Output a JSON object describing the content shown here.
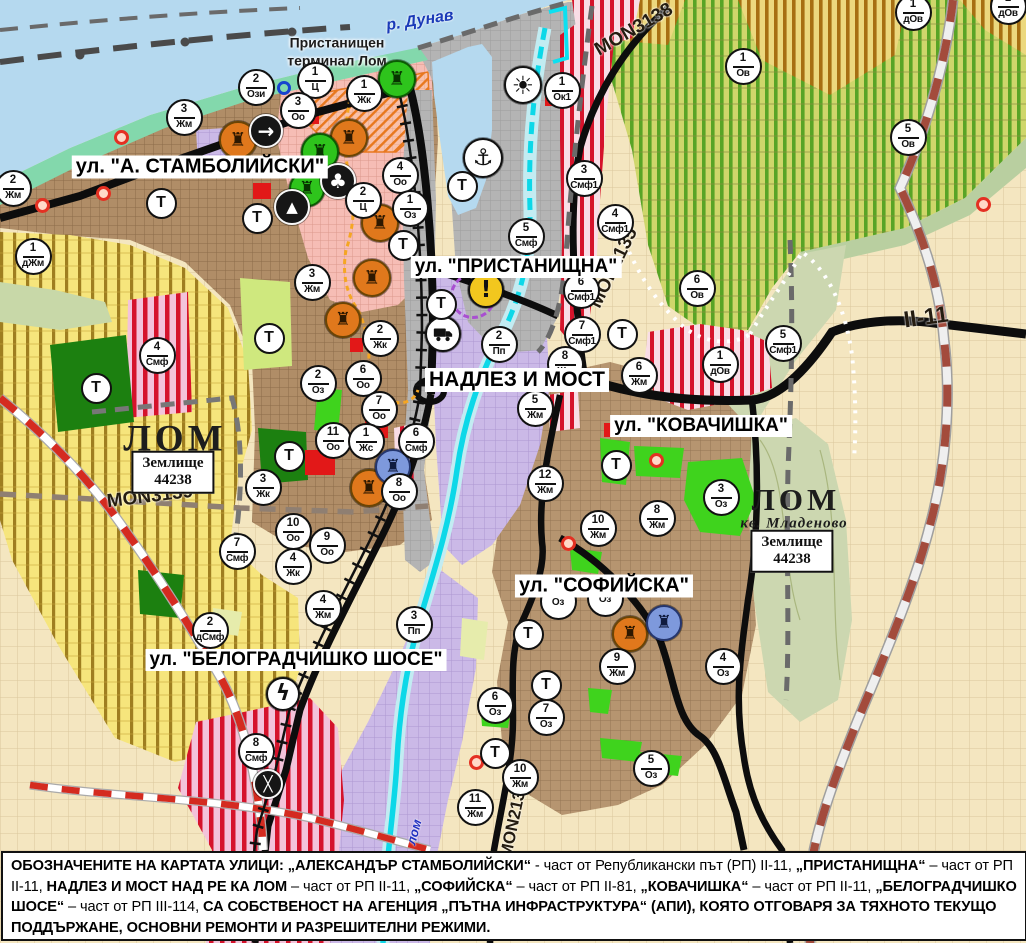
{
  "map": {
    "terminal_label": {
      "line1": "Пристанищен",
      "line2": "терминал Лом",
      "x": 337,
      "y": 52
    },
    "street_labels": [
      {
        "t": "ул. \"А. СТАМБОЛИЙСКИ\"",
        "x": 200,
        "y": 167,
        "fs": 20
      },
      {
        "t": "ул. \"ПРИСТАНИЩНА\"",
        "x": 516,
        "y": 267,
        "fs": 19
      },
      {
        "t": "НАДЛЕЗ И МОСТ",
        "x": 517,
        "y": 380,
        "fs": 21
      },
      {
        "t": "ул. \"КОВАЧИШКА\"",
        "x": 701,
        "y": 426,
        "fs": 19
      },
      {
        "t": "ул. \"СОФИЙСКА\"",
        "x": 604,
        "y": 586,
        "fs": 20
      },
      {
        "t": "ул. \"БЕЛОГРАДЧИШКО ШОСЕ\"",
        "x": 296,
        "y": 660,
        "fs": 19
      }
    ],
    "road_labels": [
      {
        "t": "MON3139",
        "x": 150,
        "y": 497,
        "rot": -7,
        "fs": 19
      },
      {
        "t": "MON3138",
        "x": 634,
        "y": 30,
        "rot": -30,
        "fs": 19
      },
      {
        "t": "MON2135",
        "x": 614,
        "y": 268,
        "rot": -64,
        "fs": 19
      },
      {
        "t": "MON2136",
        "x": 514,
        "y": 820,
        "rot": -78,
        "fs": 17
      },
      {
        "t": "II-11",
        "x": 926,
        "y": 317,
        "rot": -8,
        "fs": 23
      }
    ],
    "river_labels": [
      {
        "t": "р. Дунав",
        "x": 420,
        "y": 21,
        "rot": -9,
        "fs": 16,
        "color": "#1a3ab8"
      },
      {
        "t": "лом",
        "x": 414,
        "y": 832,
        "rot": -75,
        "fs": 13,
        "color": "#2030c0"
      }
    ],
    "city_labels": [
      {
        "t": "ЛОМ",
        "x": 175,
        "y": 439,
        "fs": 37,
        "italic": false
      },
      {
        "t": "ЛОМ",
        "x": 796,
        "y": 500,
        "fs": 31,
        "italic": false
      },
      {
        "t": "кв. Младеново",
        "x": 794,
        "y": 524,
        "fs": 15,
        "italic": true
      }
    ],
    "landholding_boxes": [
      {
        "title": "Землище",
        "number": "44238",
        "x": 173,
        "y": 472
      },
      {
        "title": "Землище",
        "number": "44238",
        "x": 792,
        "y": 551
      }
    ],
    "t_symbol": "Т",
    "t_badges": [
      {
        "x": 161,
        "y": 203
      },
      {
        "x": 257,
        "y": 218
      },
      {
        "x": 269,
        "y": 338
      },
      {
        "x": 289,
        "y": 456
      },
      {
        "x": 96,
        "y": 388
      },
      {
        "x": 441,
        "y": 304
      },
      {
        "x": 462,
        "y": 186
      },
      {
        "x": 403,
        "y": 245
      },
      {
        "x": 622,
        "y": 334
      },
      {
        "x": 616,
        "y": 465
      },
      {
        "x": 528,
        "y": 634
      },
      {
        "x": 546,
        "y": 685
      },
      {
        "x": 495,
        "y": 753
      }
    ],
    "badges": [
      {
        "n": "2",
        "c": "Ози",
        "x": 256,
        "y": 87
      },
      {
        "n": "1",
        "c": "Ц",
        "x": 315,
        "y": 80
      },
      {
        "n": "3",
        "c": "Оо",
        "x": 298,
        "y": 110
      },
      {
        "n": "1",
        "c": "Жк",
        "x": 364,
        "y": 93
      },
      {
        "n": "1",
        "c": "Ок1",
        "x": 562,
        "y": 90
      },
      {
        "n": "3",
        "c": "Жм",
        "x": 184,
        "y": 117
      },
      {
        "n": "2",
        "c": "Жм",
        "x": 13,
        "y": 188
      },
      {
        "n": "1",
        "c": "дЖм",
        "x": 33,
        "y": 256
      },
      {
        "n": "3",
        "c": "Жм",
        "x": 312,
        "y": 282
      },
      {
        "n": "4",
        "c": "Оо",
        "x": 400,
        "y": 175
      },
      {
        "n": "2",
        "c": "Ц",
        "x": 363,
        "y": 200
      },
      {
        "n": "1",
        "c": "Оз",
        "x": 410,
        "y": 208
      },
      {
        "n": "5",
        "c": "Смф",
        "x": 526,
        "y": 236
      },
      {
        "n": "3",
        "c": "Смф1",
        "x": 584,
        "y": 178
      },
      {
        "n": "4",
        "c": "Смф1",
        "x": 615,
        "y": 222
      },
      {
        "n": "6",
        "c": "Смф1",
        "x": 581,
        "y": 290
      },
      {
        "n": "7",
        "c": "Смф1",
        "x": 582,
        "y": 334
      },
      {
        "n": "8",
        "c": "Жм",
        "x": 565,
        "y": 364
      },
      {
        "n": "6",
        "c": "Жм",
        "x": 639,
        "y": 375
      },
      {
        "n": "6",
        "c": "Ов",
        "x": 697,
        "y": 288
      },
      {
        "n": "1",
        "c": "дОв",
        "x": 720,
        "y": 364
      },
      {
        "n": "5",
        "c": "Смф1",
        "x": 783,
        "y": 343
      },
      {
        "n": "1",
        "c": "Ов",
        "x": 743,
        "y": 66
      },
      {
        "n": "5",
        "c": "Ов",
        "x": 908,
        "y": 137
      },
      {
        "n": "1",
        "c": "дОв",
        "x": 913,
        "y": 12
      },
      {
        "n": "1",
        "c": "дОв",
        "x": 1008,
        "y": 6
      },
      {
        "n": "2",
        "c": "Пп",
        "x": 499,
        "y": 344
      },
      {
        "n": "5",
        "c": "Жм",
        "x": 535,
        "y": 408
      },
      {
        "n": "12",
        "c": "Жм",
        "x": 545,
        "y": 483
      },
      {
        "n": "6",
        "c": "Смф",
        "x": 416,
        "y": 441
      },
      {
        "n": "2",
        "c": "Оз",
        "x": 318,
        "y": 383
      },
      {
        "n": "11",
        "c": "Оо",
        "x": 333,
        "y": 440
      },
      {
        "n": "2",
        "c": "Жк",
        "x": 380,
        "y": 338
      },
      {
        "n": "6",
        "c": "Оо",
        "x": 363,
        "y": 378
      },
      {
        "n": "7",
        "c": "Оо",
        "x": 379,
        "y": 409
      },
      {
        "n": "1",
        "c": "Жс",
        "x": 366,
        "y": 441
      },
      {
        "n": "8",
        "c": "Оо",
        "x": 399,
        "y": 491
      },
      {
        "n": "3",
        "c": "Жк",
        "x": 263,
        "y": 487
      },
      {
        "n": "10",
        "c": "Оо",
        "x": 293,
        "y": 531
      },
      {
        "n": "9",
        "c": "Оо",
        "x": 327,
        "y": 545
      },
      {
        "n": "7",
        "c": "Смф",
        "x": 237,
        "y": 551
      },
      {
        "n": "4",
        "c": "Жк",
        "x": 293,
        "y": 566
      },
      {
        "n": "4",
        "c": "Смф",
        "x": 157,
        "y": 355
      },
      {
        "n": "2",
        "c": "дСмф",
        "x": 210,
        "y": 630
      },
      {
        "n": "4",
        "c": "Жм",
        "x": 323,
        "y": 608
      },
      {
        "n": "3",
        "c": "Пп",
        "x": 414,
        "y": 624
      },
      {
        "n": "8",
        "c": "Смф",
        "x": 256,
        "y": 751
      },
      {
        "n": "8",
        "c": "Жм",
        "x": 657,
        "y": 518
      },
      {
        "n": "10",
        "c": "Жм",
        "x": 598,
        "y": 528
      },
      {
        "n": "3",
        "c": "Оз",
        "x": 721,
        "y": 497
      },
      {
        "n": "9",
        "c": "Жм",
        "x": 617,
        "y": 666
      },
      {
        "n": "4",
        "c": "Оз",
        "x": 723,
        "y": 666
      },
      {
        "n": "6",
        "c": "Оз",
        "x": 495,
        "y": 705
      },
      {
        "n": "7",
        "c": "Оз",
        "x": 546,
        "y": 717
      },
      {
        "n": "5",
        "c": "Оз",
        "x": 651,
        "y": 768
      },
      {
        "n": "10",
        "c": "Жм",
        "x": 520,
        "y": 777
      },
      {
        "n": "11",
        "c": "Жм",
        "x": 475,
        "y": 807
      },
      {
        "n": "",
        "c": "Оз",
        "x": 558,
        "y": 601
      },
      {
        "n": "",
        "c": "Оз",
        "x": 605,
        "y": 598
      }
    ],
    "icons": [
      {
        "k": "monument-icon",
        "x": 238,
        "y": 140,
        "bg": "#e0781c",
        "bd": "#6b4404",
        "fg": "#2d1800",
        "g": "♜",
        "s": 38
      },
      {
        "k": "monument-icon",
        "x": 349,
        "y": 138,
        "bg": "#e0781c",
        "bd": "#6b4404",
        "fg": "#2d1800",
        "g": "♜",
        "s": 38
      },
      {
        "k": "monument-icon",
        "x": 380,
        "y": 223,
        "bg": "#e0781c",
        "bd": "#6b4404",
        "fg": "#2d1800",
        "g": "♜",
        "s": 38
      },
      {
        "k": "monument-icon",
        "x": 372,
        "y": 278,
        "bg": "#e0781c",
        "bd": "#6b4404",
        "fg": "#2d1800",
        "g": "♜",
        "s": 38
      },
      {
        "k": "monument-icon",
        "x": 343,
        "y": 320,
        "bg": "#e0781c",
        "bd": "#6b4404",
        "fg": "#2d1800",
        "g": "♜",
        "s": 36
      },
      {
        "k": "monument-icon",
        "x": 369,
        "y": 488,
        "bg": "#e0781c",
        "bd": "#6b4404",
        "fg": "#2d1800",
        "g": "♜",
        "s": 38
      },
      {
        "k": "monument-icon",
        "x": 630,
        "y": 634,
        "bg": "#e0781c",
        "bd": "#6b4404",
        "fg": "#2d1800",
        "g": "♜",
        "s": 36
      },
      {
        "k": "monument-green-icon",
        "x": 397,
        "y": 79,
        "bg": "#2ec41c",
        "bd": "#0b5c04",
        "fg": "#073300",
        "g": "♜",
        "s": 38
      },
      {
        "k": "monument-green-icon",
        "x": 320,
        "y": 152,
        "bg": "#2ec41c",
        "bd": "#0b5c04",
        "fg": "#073300",
        "g": "♜",
        "s": 38
      },
      {
        "k": "monument-green-icon",
        "x": 307,
        "y": 189,
        "bg": "#2ec41c",
        "bd": "#0b5c04",
        "fg": "#073300",
        "g": "♜",
        "s": 36
      },
      {
        "k": "monument-blue-icon",
        "x": 393,
        "y": 467,
        "bg": "#7e99dc",
        "bd": "#25366e",
        "fg": "#101c40",
        "g": "♜",
        "s": 36
      },
      {
        "k": "monument-blue-icon",
        "x": 664,
        "y": 623,
        "bg": "#7e99dc",
        "bd": "#25366e",
        "fg": "#101c40",
        "g": "♜",
        "s": 36
      },
      {
        "k": "arrow-circle-icon",
        "x": 266,
        "y": 131,
        "bg": "#161616",
        "bd": "#f8f8f8",
        "fg": "#ffffff",
        "g": "→",
        "s": 34,
        "fs": 20
      },
      {
        "k": "clover-icon",
        "x": 338,
        "y": 181,
        "bg": "#161616",
        "bd": "#f8f8f8",
        "fg": "#ffffff",
        "g": "♣",
        "s": 36,
        "fs": 20
      },
      {
        "k": "peak-icon",
        "x": 292,
        "y": 207,
        "bg": "#161616",
        "bd": "#f8f8f8",
        "fg": "#ffffff",
        "g": "▲",
        "s": 36,
        "fs": 15
      },
      {
        "k": "truck-icon",
        "x": 443,
        "y": 334,
        "bg": "#ffffff",
        "bd": "#111111",
        "fg": "#111111",
        "svg": "truck",
        "s": 36
      },
      {
        "k": "anchor-icon",
        "x": 483,
        "y": 158,
        "bg": "#ffffff",
        "bd": "#111111",
        "fg": "#111111",
        "g": "⚓",
        "s": 40,
        "fs": 23
      },
      {
        "k": "sun-icon",
        "x": 523,
        "y": 85,
        "bg": "#ffffff",
        "bd": "#111111",
        "fg": "#111111",
        "g": "☀",
        "s": 38,
        "fs": 25
      },
      {
        "k": "warning-icon",
        "x": 486,
        "y": 290,
        "bg": "#f2c71e",
        "bd": "#111111",
        "fg": "#111111",
        "g": "!",
        "s": 36,
        "fs": 23
      },
      {
        "k": "lightning-icon",
        "x": 283,
        "y": 694,
        "bg": "#ffffff",
        "bd": "#111111",
        "fg": "#111111",
        "g": "ϟ",
        "s": 34,
        "fs": 22
      },
      {
        "k": "crossing-icon",
        "x": 268,
        "y": 784,
        "bg": "#161616",
        "bd": "#f8f8f8",
        "fg": "#ffffff",
        "g": "╳",
        "s": 30,
        "fs": 15
      }
    ],
    "markers": {
      "red_dots": [
        {
          "x": 121,
          "y": 137
        },
        {
          "x": 103,
          "y": 193
        },
        {
          "x": 42,
          "y": 205
        },
        {
          "x": 568,
          "y": 543
        },
        {
          "x": 476,
          "y": 762
        },
        {
          "x": 656,
          "y": 460
        },
        {
          "x": 983,
          "y": 204
        }
      ],
      "blue_ring": {
        "x": 284,
        "y": 88
      },
      "protection_ring": {
        "x": 473,
        "y": 296
      }
    },
    "colors": {
      "water": "#b5d9ef",
      "residential_brown": "#b08d67",
      "mixed_red_stripe": "#d5132b",
      "vineyard_green": "#58a426",
      "farm_yellow": "#f6e57c",
      "industrial_purple": "#cbb9e7",
      "park_green": "#3fd31d",
      "river_cyan": "#0cd8e8"
    }
  },
  "footer": {
    "segments": [
      {
        "t": "ОБОЗНАЧЕНИТЕ НА КАРТАТА УЛИЦИ: ",
        "b": true
      },
      {
        "t": "„АЛЕКСАНДЪР СТАМБОЛИЙСКИ“",
        "b": true
      },
      {
        "t": " - част от Републикански път (РП) II-11, ",
        "b": false
      },
      {
        "t": "„ПРИСТАНИЩНА“",
        "b": true
      },
      {
        "t": " – част от РП II-11, ",
        "b": false
      },
      {
        "t": "НАДЛЕЗ И МОСТ НАД РЕ КА ЛОМ",
        "b": true
      },
      {
        "t": " – част от РП II-11, ",
        "b": false
      },
      {
        "t": "„СОФИЙСКА“",
        "b": true
      },
      {
        "t": " – част от РП II-81, ",
        "b": false
      },
      {
        "t": "„КОВАЧИШКА“",
        "b": true
      },
      {
        "t": " – част от РП II-11, ",
        "b": false
      },
      {
        "t": "„БЕЛОГРАДЧИШКО ШОСЕ“",
        "b": true
      },
      {
        "t": " – част от РП III-114, ",
        "b": false
      },
      {
        "t": "СА СОБСТВЕНОСТ НА АГЕНЦИЯ „ПЪТНА ИНФРАСТРУКТУРА“ (АПИ), КОЯТО ОТГОВАРЯ ЗА ТЯХНОТО ТЕКУЩО ПОДДЪРЖАНЕ, ОСНОВНИ РЕМОНТИ И РАЗРЕШИТЕЛНИ РЕЖИМИ.",
        "b": true
      }
    ]
  }
}
